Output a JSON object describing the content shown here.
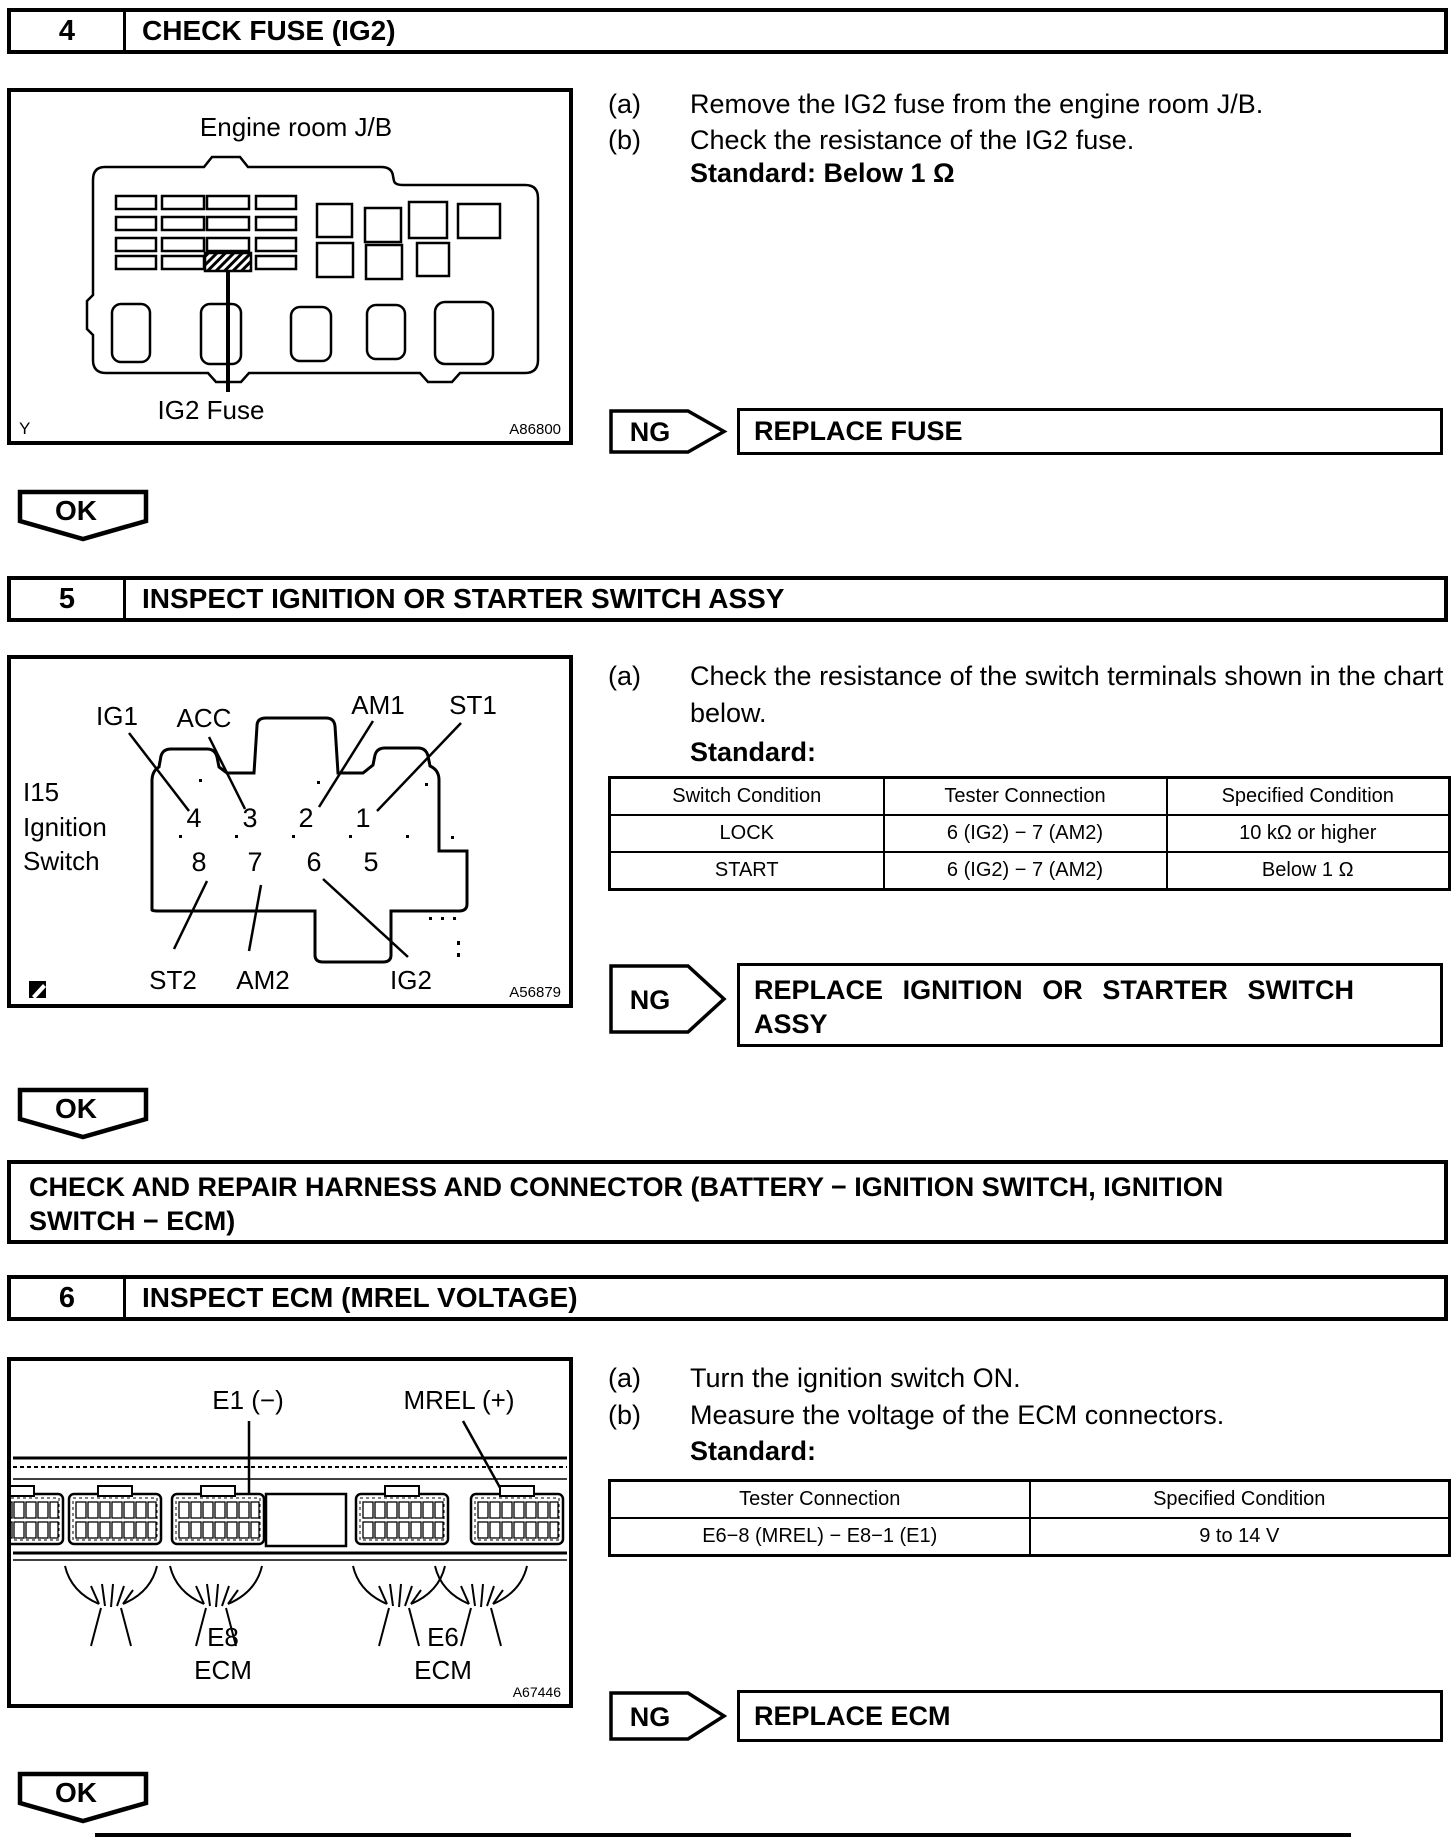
{
  "step4": {
    "number": "4",
    "title": "CHECK FUSE (IG2)",
    "figure": {
      "title": "Engine room J/B",
      "callout": "IG2 Fuse",
      "corner_mark": "Y",
      "code": "A86800"
    },
    "items": [
      {
        "idx": "(a)",
        "text": "Remove the IG2 fuse from the engine room J/B."
      },
      {
        "idx": "(b)",
        "text": "Check the resistance of the IG2 fuse."
      }
    ],
    "standard": "Standard: Below 1 Ω",
    "ng": "NG",
    "ng_action": "REPLACE FUSE",
    "ok": "OK"
  },
  "step5": {
    "number": "5",
    "title": "INSPECT IGNITION OR STARTER SWITCH ASSY",
    "figure": {
      "component": [
        "I15",
        "Ignition",
        "Switch"
      ],
      "top_labels": [
        "IG1",
        "ACC",
        "AM1",
        "ST1"
      ],
      "top_pins": [
        "4",
        "3",
        "2",
        "1"
      ],
      "bottom_pins": [
        "8",
        "7",
        "6",
        "5"
      ],
      "bottom_labels": [
        "ST2",
        "AM2",
        "IG2"
      ],
      "code": "A56879"
    },
    "items": [
      {
        "idx": "(a)",
        "text": "Check the resistance of the switch terminals shown in the chart below."
      }
    ],
    "standard": "Standard:",
    "table": {
      "headers": [
        "Switch Condition",
        "Tester Connection",
        "Specified Condition"
      ],
      "rows": [
        [
          "LOCK",
          "6 (IG2) − 7 (AM2)",
          "10 kΩ or higher"
        ],
        [
          "START",
          "6 (IG2) − 7 (AM2)",
          "Below 1 Ω"
        ]
      ]
    },
    "ng": "NG",
    "ng_action": "REPLACE IGNITION OR STARTER SWITCH ASSY",
    "ok": "OK"
  },
  "harness": {
    "text": "CHECK AND REPAIR HARNESS AND CONNECTOR (BATTERY − IGNITION SWITCH, IGNITION SWITCH − ECM)"
  },
  "step6": {
    "number": "6",
    "title": "INSPECT ECM (MREL VOLTAGE)",
    "figure": {
      "probe_negative": "E1 (−)",
      "probe_positive": "MREL (+)",
      "left_connector": "E8",
      "left_connector_sub": "ECM",
      "right_connector": "E6",
      "right_connector_sub": "ECM",
      "code": "A67446"
    },
    "items": [
      {
        "idx": "(a)",
        "text": "Turn the ignition switch ON."
      },
      {
        "idx": "(b)",
        "text": "Measure the voltage of the ECM connectors."
      }
    ],
    "standard": "Standard:",
    "table": {
      "headers": [
        "Tester Connection",
        "Specified Condition"
      ],
      "rows": [
        [
          "E6−8 (MREL) − E8−1 (E1)",
          "9 to 14 V"
        ]
      ]
    },
    "ng": "NG",
    "ng_action": "REPLACE ECM",
    "ok": "OK"
  }
}
